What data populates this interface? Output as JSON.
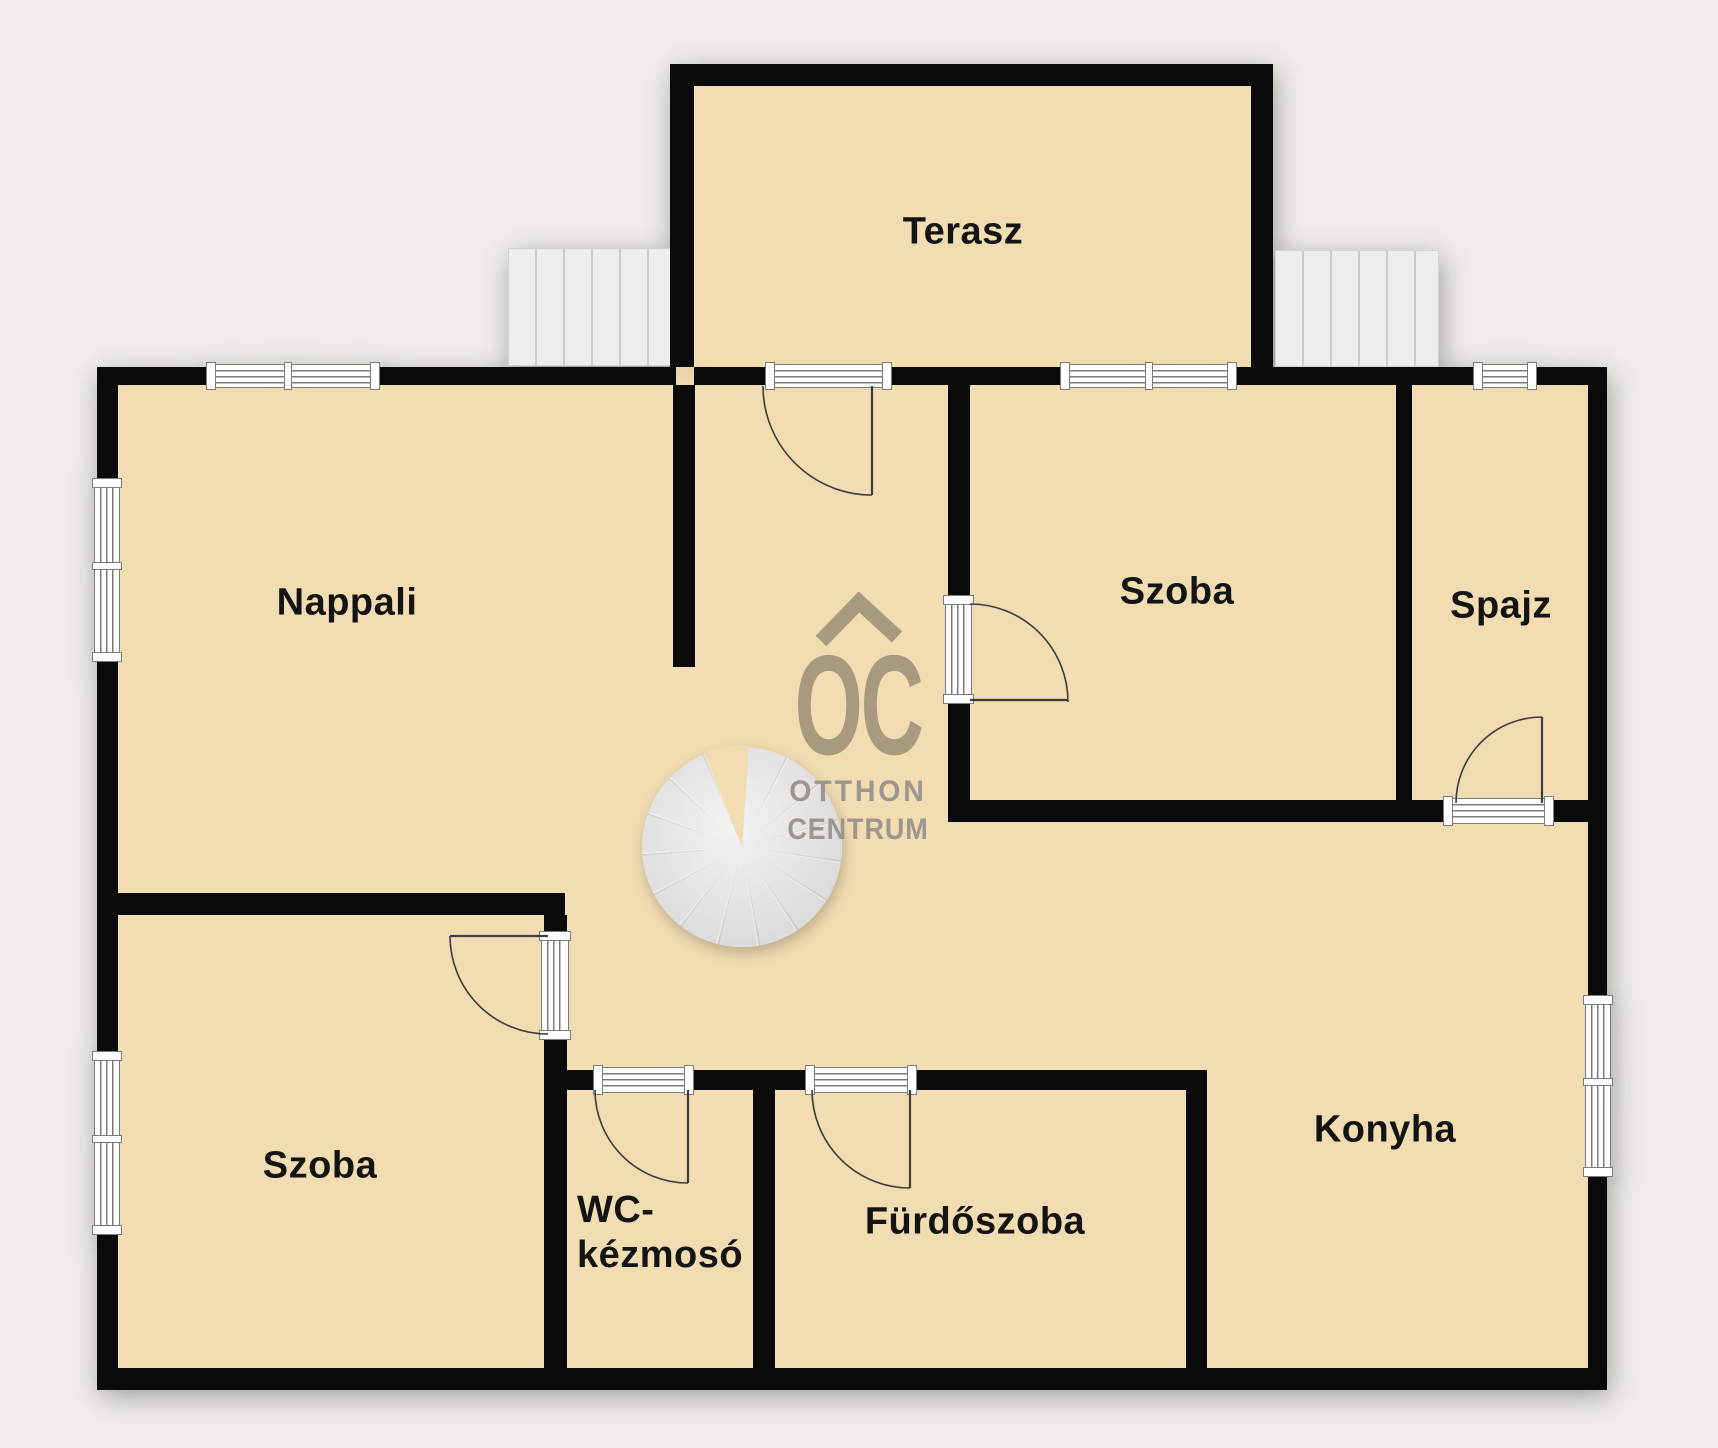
{
  "floorplan": {
    "rooms": {
      "terasz": {
        "label": "Terasz"
      },
      "nappali": {
        "label": "Nappali"
      },
      "szoba_felso": {
        "label": "Szoba"
      },
      "spajz": {
        "label": "Spajz"
      },
      "szoba_also": {
        "label": "Szoba"
      },
      "wc": {
        "label_line1": "WC-",
        "label_line2": "kézmosó"
      },
      "furdoszoba": {
        "label": "Fürdőszoba"
      },
      "konyha": {
        "label": "Konyha"
      }
    },
    "watermark": {
      "logo_text": "OC",
      "brand_line1": "OTTHON",
      "brand_line2": "CENTRUM"
    }
  },
  "colors": {
    "bg": "#efeeea",
    "floor": "#f2dcb2",
    "wall": "#0a0a0a",
    "wf": "#7c7c7c",
    "label": "#141414",
    "wm1": "#a79a7f",
    "wm2": "#9b978f"
  }
}
